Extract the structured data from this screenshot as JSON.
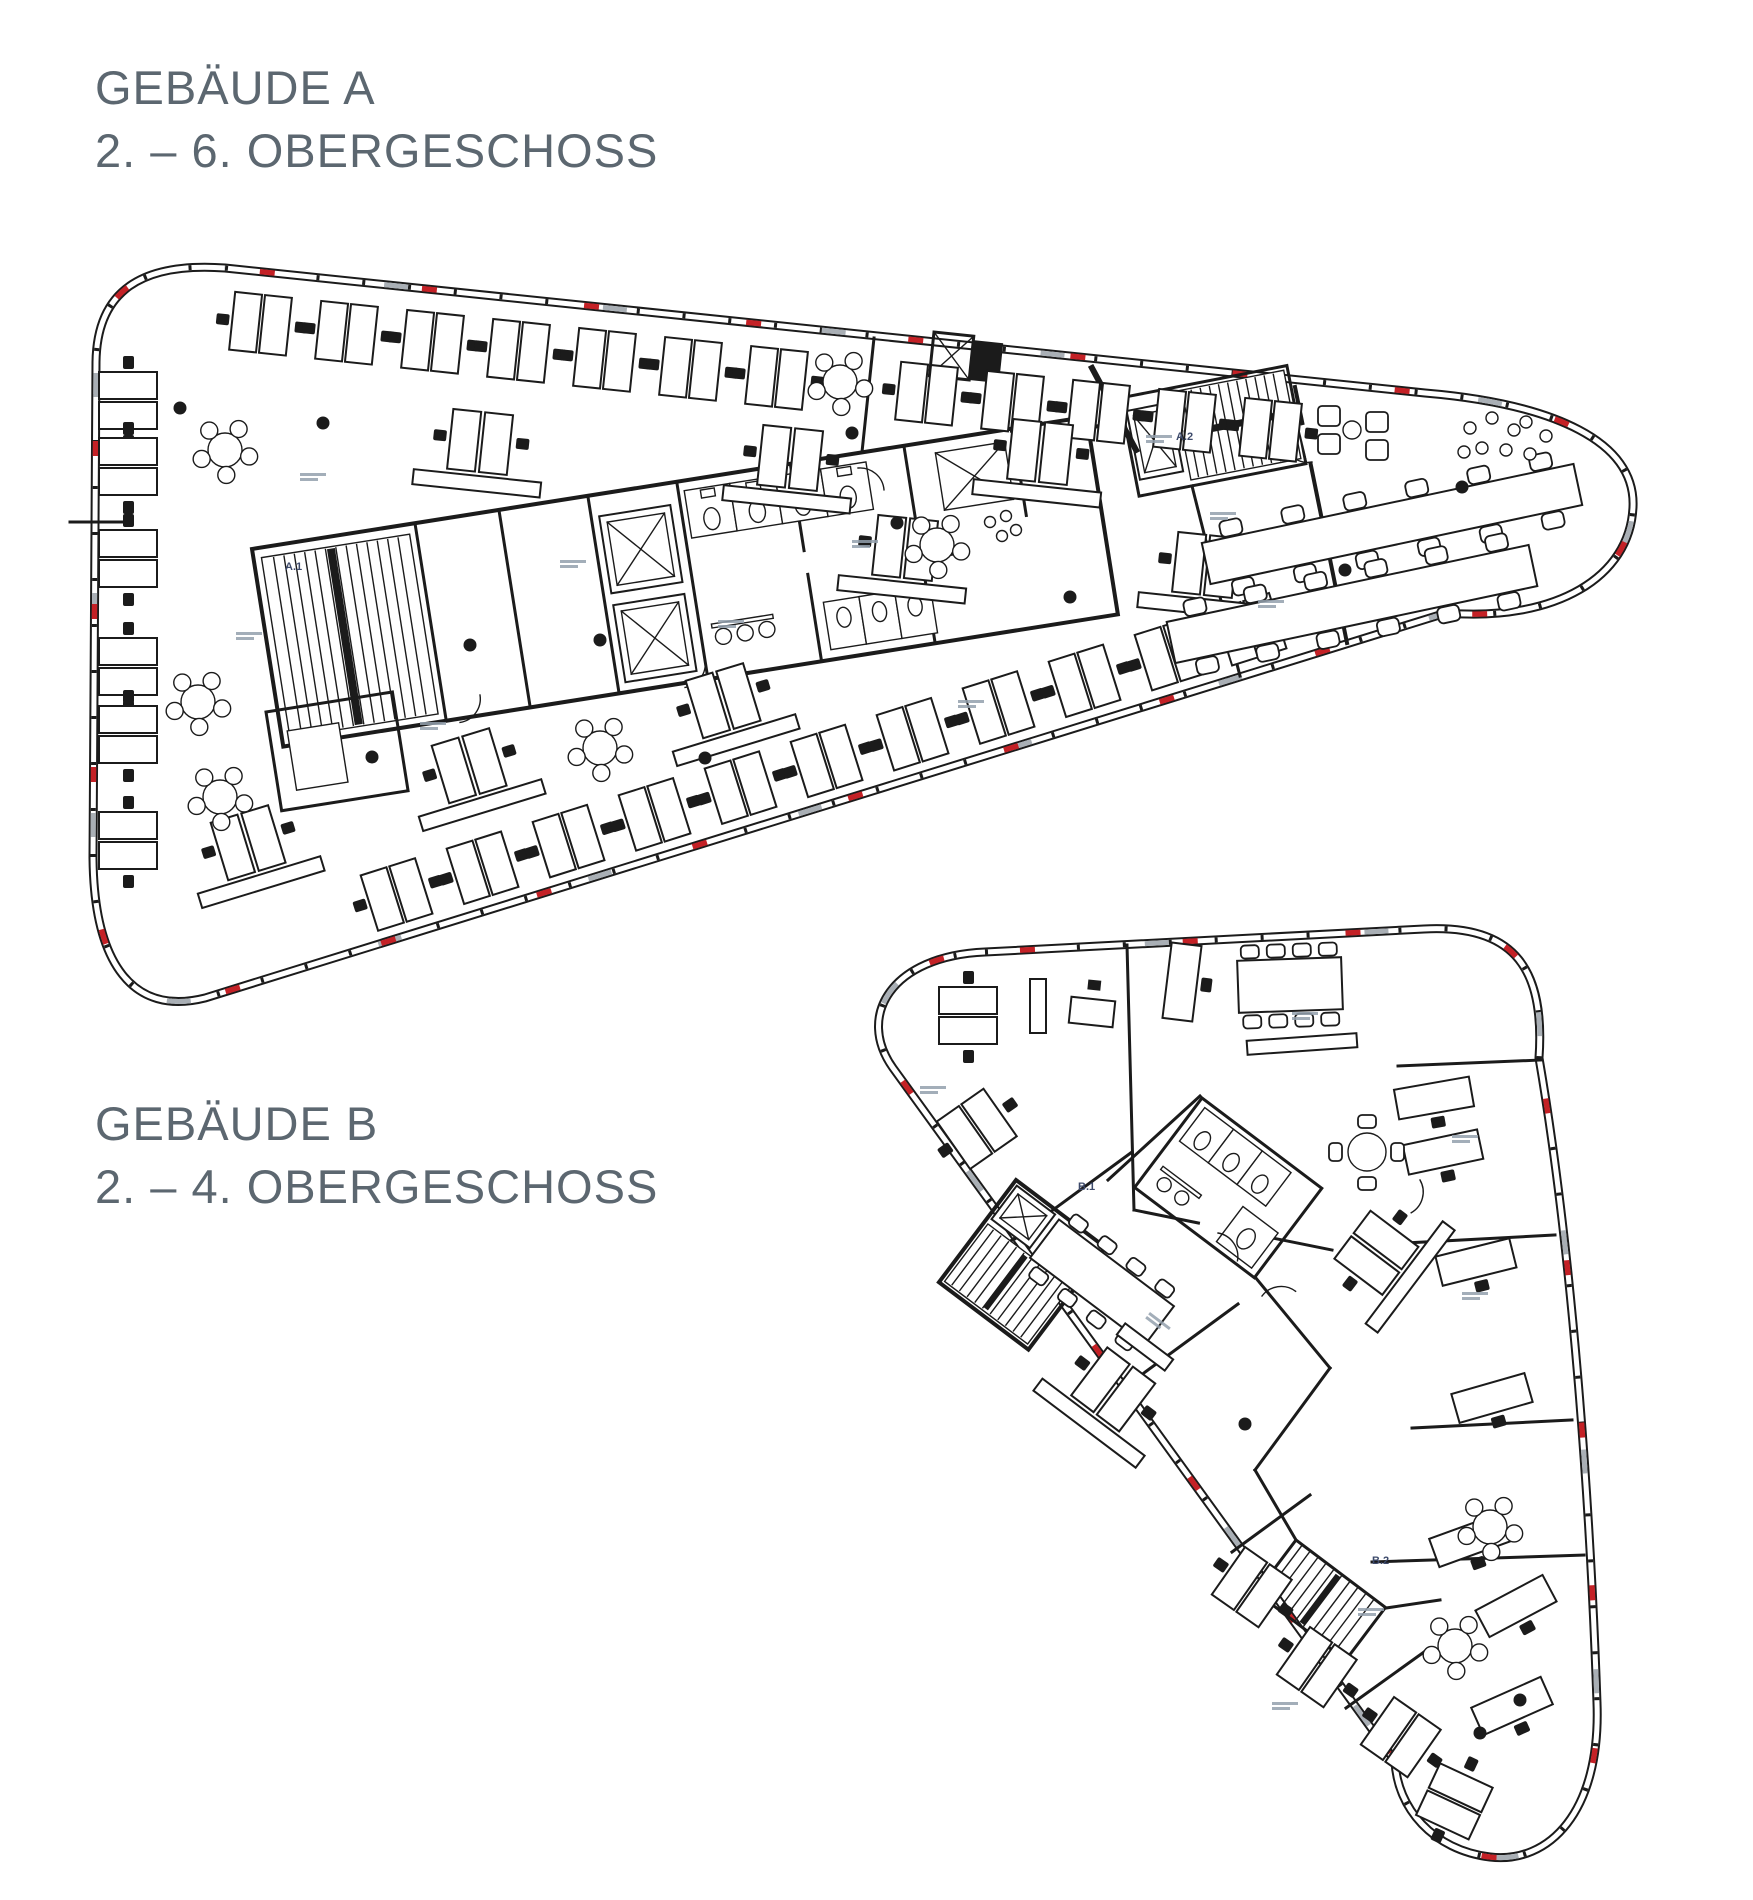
{
  "page": {
    "background_color": "#ffffff"
  },
  "colors": {
    "title_text": "#5c6770",
    "plan_line": "#1b1b1b",
    "facade_red": "#c42126",
    "facade_gray": "#a9afb5",
    "core_label_text": "#3d4a6b"
  },
  "buildings": {
    "a": {
      "title_line1": "GEBÄUDE A",
      "title_line2": "2. – 6. OBERGESCHOSS",
      "core_labels": {
        "main": "A.1",
        "secondary": "A.2"
      }
    },
    "b": {
      "title_line1": "GEBÄUDE B",
      "title_line2": "2. – 4. OBERGESCHOSS",
      "core_labels": {
        "main": "B.1",
        "secondary": "B.2"
      }
    }
  }
}
